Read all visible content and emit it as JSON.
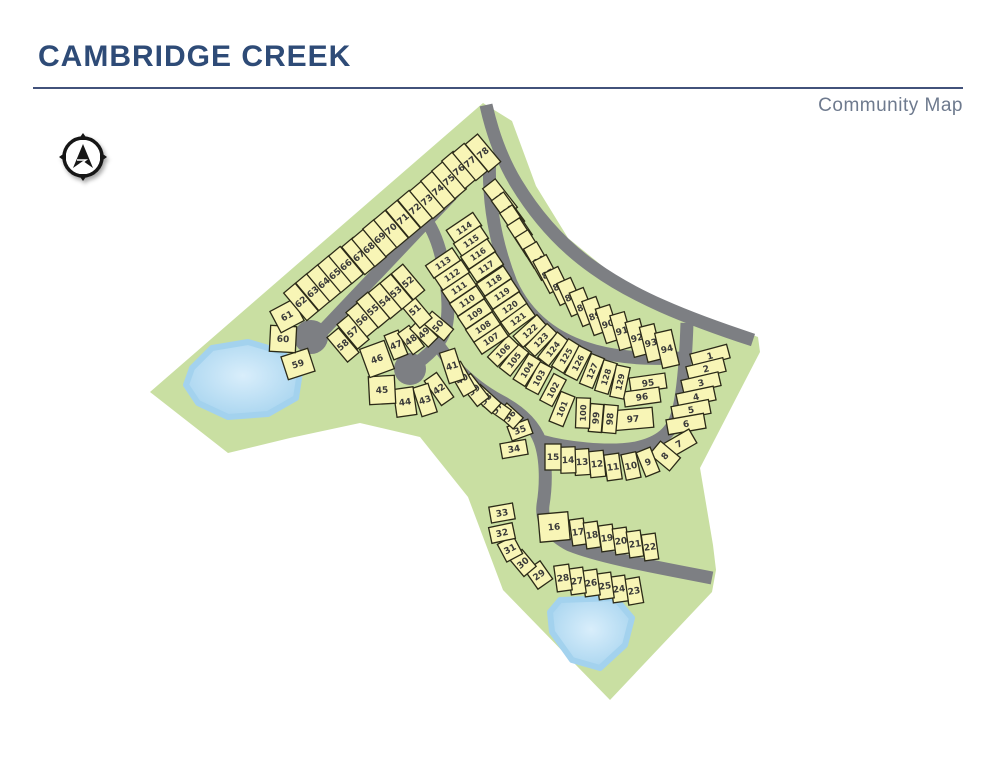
{
  "header": {
    "title": "CAMBRIDGE CREEK",
    "subtitle": "Community Map"
  },
  "map": {
    "colors": {
      "land": "#c9dfa2",
      "road": "#7d7f83",
      "lot_fill": "#f8f5b6",
      "lot_stroke": "#2b2a18",
      "lot_text": "#3a3a3a",
      "pond_edge": "#a3d2ee",
      "pond_center": "#d9eefb"
    },
    "land_main": "150,392 483,103 512,121 536,186 568,238 622,282 692,313 758,337 760,352 700,468 713,545 716,570 712,592 610,700 503,590 468,497 420,437 360,423 290,438 228,453",
    "ponds": [
      "192,368 212,348 248,342 282,352 300,372 296,398 268,414 228,417 198,403 186,385",
      "560,600 615,598 632,618 625,645 600,668 572,660 552,632 550,612"
    ],
    "roads": [
      "M486,105 C492,132 501,158 516,183 C536,216 561,245 594,268 C633,296 683,317 753,340",
      "M490,152 C487,200 496,245 511,283 C528,320 558,341 595,351 C625,359 655,359 683,358",
      "M687,323 C686,352 684,390 678,412 C673,432 660,443 636,448 C607,453 566,448 541,441",
      "M314,340 L492,152",
      "M410,368 C428,356 441,344 446,327 C450,309 447,284 443,264 C439,244 433,228 423,216",
      "M438,345 C456,371 478,389 500,401 C521,412 534,425 540,441 C547,460 546,487 543,505 C541,521 549,534 570,545 C600,557 650,566 712,578"
    ],
    "culdesacs": [
      [
        311,
        337,
        17
      ],
      [
        410,
        369,
        16
      ]
    ],
    "lots": [
      [
        1,
        710,
        356,
        -15,
        38,
        14
      ],
      [
        2,
        706,
        369,
        -14,
        38,
        14
      ],
      [
        3,
        701,
        383,
        -13,
        38,
        14
      ],
      [
        4,
        696,
        397,
        -12,
        38,
        14
      ],
      [
        5,
        691,
        410,
        -11,
        38,
        14
      ],
      [
        6,
        686,
        424,
        -10,
        38,
        15
      ],
      [
        7,
        679,
        444,
        -30,
        32,
        16
      ],
      [
        8,
        665,
        456,
        -50,
        17,
        26
      ],
      [
        9,
        648,
        462,
        -22,
        15,
        26
      ],
      [
        10,
        631,
        466,
        -12,
        15,
        26
      ],
      [
        11,
        613,
        467,
        -8,
        15,
        26
      ],
      [
        12,
        597,
        464,
        -6,
        15,
        26
      ],
      [
        13,
        582,
        462,
        -4,
        15,
        26
      ],
      [
        14,
        568,
        460,
        -2,
        15,
        26
      ],
      [
        15,
        553,
        457,
        0,
        16,
        26
      ],
      [
        16,
        554,
        527,
        -5,
        30,
        28
      ],
      [
        17,
        578,
        532,
        -8,
        14,
        26
      ],
      [
        18,
        592,
        535,
        -8,
        14,
        26
      ],
      [
        19,
        607,
        538,
        -8,
        14,
        26
      ],
      [
        20,
        621,
        541,
        -8,
        14,
        26
      ],
      [
        21,
        635,
        544,
        -8,
        14,
        26
      ],
      [
        22,
        650,
        547,
        -8,
        14,
        26
      ],
      [
        23,
        634,
        591,
        -10,
        15,
        26
      ],
      [
        24,
        619,
        589,
        -8,
        15,
        26
      ],
      [
        25,
        605,
        586,
        -8,
        15,
        26
      ],
      [
        26,
        591,
        583,
        -8,
        15,
        26
      ],
      [
        27,
        577,
        581,
        -8,
        15,
        26
      ],
      [
        28,
        563,
        578,
        -8,
        15,
        26
      ],
      [
        29,
        539,
        575,
        -35,
        18,
        22
      ],
      [
        30,
        523,
        563,
        -40,
        16,
        22
      ],
      [
        31,
        510,
        549,
        -28,
        18,
        20
      ],
      [
        32,
        502,
        533,
        -12,
        24,
        16
      ],
      [
        33,
        502,
        513,
        -10,
        24,
        16
      ],
      [
        34,
        514,
        449,
        -10,
        26,
        15
      ],
      [
        35,
        520,
        430,
        -20,
        22,
        15
      ],
      [
        36,
        510,
        416,
        -48,
        15,
        22
      ],
      [
        37,
        497,
        408,
        -55,
        13,
        26
      ],
      [
        38,
        486,
        399,
        -48,
        14,
        28
      ],
      [
        39,
        474,
        390,
        -38,
        15,
        30
      ],
      [
        40,
        462,
        379,
        -30,
        15,
        32
      ],
      [
        41,
        452,
        366,
        -18,
        16,
        32
      ],
      [
        42,
        439,
        389,
        -35,
        15,
        30
      ],
      [
        43,
        425,
        400,
        -18,
        16,
        30
      ],
      [
        44,
        405,
        402,
        -8,
        20,
        28
      ],
      [
        45,
        382,
        390,
        -3,
        26,
        28
      ],
      [
        46,
        377,
        359,
        -20,
        26,
        30
      ],
      [
        47,
        396,
        345,
        -22,
        15,
        26
      ],
      [
        48,
        411,
        340,
        -36,
        14,
        26
      ],
      [
        49,
        424,
        333,
        -45,
        14,
        26
      ],
      [
        50,
        438,
        326,
        -50,
        15,
        28
      ],
      [
        51,
        415,
        310,
        -40,
        16,
        34
      ],
      [
        52,
        408,
        282,
        -40,
        15,
        34
      ],
      [
        53,
        396,
        292,
        -40,
        15,
        34
      ],
      [
        54,
        385,
        301,
        -40,
        15,
        34
      ],
      [
        55,
        373,
        310,
        -40,
        15,
        34
      ],
      [
        56,
        362,
        320,
        -40,
        15,
        32
      ],
      [
        57,
        353,
        332,
        -40,
        15,
        32
      ],
      [
        58,
        343,
        345,
        -40,
        15,
        32
      ],
      [
        59,
        298,
        364,
        -18,
        28,
        24
      ],
      [
        60,
        283,
        339,
        3,
        26,
        26
      ],
      [
        61,
        287,
        316,
        -28,
        26,
        24
      ],
      [
        62,
        301,
        302,
        -40,
        15,
        36
      ],
      [
        63,
        313,
        292,
        -40,
        15,
        36
      ],
      [
        64,
        324,
        283,
        -40,
        15,
        36
      ],
      [
        65,
        335,
        274,
        -40,
        15,
        36
      ],
      [
        66,
        346,
        265,
        -40,
        15,
        36
      ],
      [
        67,
        359,
        256,
        -40,
        15,
        36
      ],
      [
        68,
        369,
        248,
        -40,
        15,
        36
      ],
      [
        69,
        380,
        238,
        -40,
        15,
        36
      ],
      [
        70,
        391,
        229,
        -40,
        15,
        36
      ],
      [
        71,
        403,
        219,
        -40,
        15,
        36
      ],
      [
        72,
        415,
        209,
        -40,
        15,
        36
      ],
      [
        73,
        427,
        200,
        -40,
        15,
        36
      ],
      [
        74,
        438,
        190,
        -40,
        15,
        36
      ],
      [
        75,
        449,
        180,
        -40,
        15,
        36
      ],
      [
        76,
        459,
        170,
        -40,
        15,
        36
      ],
      [
        77,
        470,
        162,
        -40,
        15,
        36
      ],
      [
        78,
        483,
        153,
        -40,
        16,
        36
      ],
      [
        79,
        500,
        198,
        -38,
        16,
        36
      ],
      [
        80,
        508,
        211,
        -36,
        15,
        36
      ],
      [
        81,
        516,
        224,
        -34,
        15,
        36
      ],
      [
        82,
        523,
        237,
        -33,
        15,
        36
      ],
      [
        83,
        531,
        249,
        -32,
        15,
        36
      ],
      [
        84,
        539,
        261,
        -30,
        15,
        36
      ],
      [
        85,
        548,
        274,
        -28,
        15,
        36
      ],
      [
        86,
        559,
        286,
        -26,
        15,
        36
      ],
      [
        87,
        571,
        297,
        -24,
        15,
        36
      ],
      [
        88,
        583,
        307,
        -22,
        15,
        36
      ],
      [
        89,
        595,
        316,
        -20,
        15,
        36
      ],
      [
        90,
        608,
        324,
        -18,
        15,
        36
      ],
      [
        91,
        622,
        331,
        -16,
        15,
        36
      ],
      [
        92,
        637,
        338,
        -15,
        15,
        36
      ],
      [
        93,
        651,
        343,
        -14,
        15,
        36
      ],
      [
        94,
        667,
        349,
        -13,
        17,
        36
      ],
      [
        95,
        648,
        383,
        -8,
        36,
        15
      ],
      [
        96,
        642,
        397,
        -8,
        36,
        15
      ],
      [
        97,
        633,
        419,
        -5,
        40,
        20
      ],
      [
        98,
        610,
        419,
        -85,
        28,
        14
      ],
      [
        99,
        596,
        418,
        -85,
        28,
        13
      ],
      [
        100,
        583,
        413,
        -88,
        30,
        14
      ],
      [
        101,
        562,
        409,
        -68,
        32,
        15
      ],
      [
        102,
        553,
        390,
        -62,
        30,
        14
      ],
      [
        103,
        539,
        378,
        -62,
        30,
        14
      ],
      [
        104,
        527,
        370,
        -58,
        30,
        14
      ],
      [
        105,
        514,
        360,
        -52,
        30,
        14
      ],
      [
        106,
        503,
        351,
        -46,
        30,
        14
      ],
      [
        107,
        491,
        339,
        -34,
        32,
        15
      ],
      [
        108,
        483,
        327,
        -34,
        32,
        15
      ],
      [
        109,
        475,
        314,
        -34,
        32,
        15
      ],
      [
        110,
        467,
        301,
        -34,
        32,
        15
      ],
      [
        111,
        459,
        288,
        -34,
        32,
        15
      ],
      [
        112,
        452,
        275,
        -34,
        32,
        15
      ],
      [
        113,
        443,
        263,
        -34,
        32,
        15
      ],
      [
        114,
        464,
        228,
        -34,
        32,
        16
      ],
      [
        115,
        471,
        241,
        -34,
        32,
        15
      ],
      [
        116,
        478,
        254,
        -34,
        32,
        15
      ],
      [
        117,
        486,
        267,
        -34,
        32,
        15
      ],
      [
        118,
        494,
        281,
        -34,
        32,
        15
      ],
      [
        119,
        502,
        294,
        -34,
        32,
        15
      ],
      [
        120,
        510,
        307,
        -34,
        32,
        15
      ],
      [
        121,
        518,
        319,
        -36,
        32,
        15
      ],
      [
        122,
        530,
        331,
        -42,
        32,
        15
      ],
      [
        123,
        541,
        340,
        -46,
        32,
        14
      ],
      [
        124,
        553,
        349,
        -52,
        32,
        14
      ],
      [
        125,
        566,
        356,
        -58,
        32,
        14
      ],
      [
        126,
        578,
        363,
        -63,
        32,
        14
      ],
      [
        127,
        592,
        371,
        -68,
        32,
        14
      ],
      [
        128,
        606,
        377,
        -73,
        32,
        14
      ],
      [
        129,
        620,
        382,
        -78,
        32,
        14
      ]
    ]
  }
}
